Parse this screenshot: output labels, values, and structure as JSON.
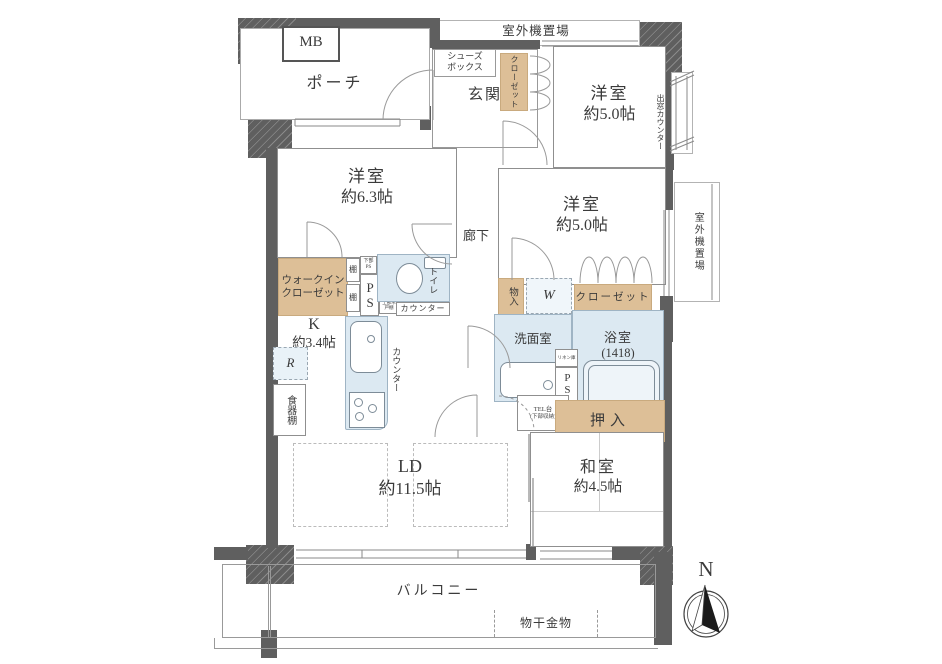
{
  "colors": {
    "wall": "#5f5f5f",
    "closet_tan": "#ddbf97",
    "wet_blue": "#dce9f2",
    "line": "#9a9a9a"
  },
  "labels": {
    "mb": "MB",
    "porch": "ポーチ",
    "shoes_box_1": "シューズ",
    "shoes_box_2": "ボックス",
    "entrance": "玄関",
    "entrance_closet": "クローゼット",
    "outdoor_top": "室外機置場",
    "outdoor_right": "室外機置場",
    "bay_counter": "出窓カウンター",
    "west_a_name": "洋室",
    "west_a_size": "約5.0帖",
    "west_b_name": "洋室",
    "west_b_size": "約6.3帖",
    "west_c_name": "洋室",
    "west_c_size": "約5.0帖",
    "corridor": "廊下",
    "wic_1": "ウォークイン",
    "wic_2": "クローゼット",
    "shelf_a": "棚",
    "shelf_b": "棚",
    "lower_ps": "下部PS",
    "ps_main": "PS",
    "upper_cabinet": "上部吊戸棚",
    "toilet": "トイレ",
    "counter_a": "カウンター",
    "storage": "物入",
    "washer": "W",
    "closet_c": "クローゼット",
    "kitchen_name": "K",
    "kitchen_size": "約3.4帖",
    "fridge": "R",
    "cupboard": "食器棚",
    "counter_b": "カウンター",
    "washroom": "洗面室",
    "bath_name": "浴室",
    "bath_size": "(1418)",
    "linen": "リネン庫",
    "ps_b": "PS",
    "tel_1": "TEL台",
    "tel_2": "(下部収納)",
    "oshiire": "押入",
    "ld_name": "LD",
    "ld_size": "約11.5帖",
    "washitsu_name": "和室",
    "washitsu_size": "約4.5帖",
    "balcony": "バルコニー",
    "laundry": "物干金物",
    "north": "N"
  }
}
